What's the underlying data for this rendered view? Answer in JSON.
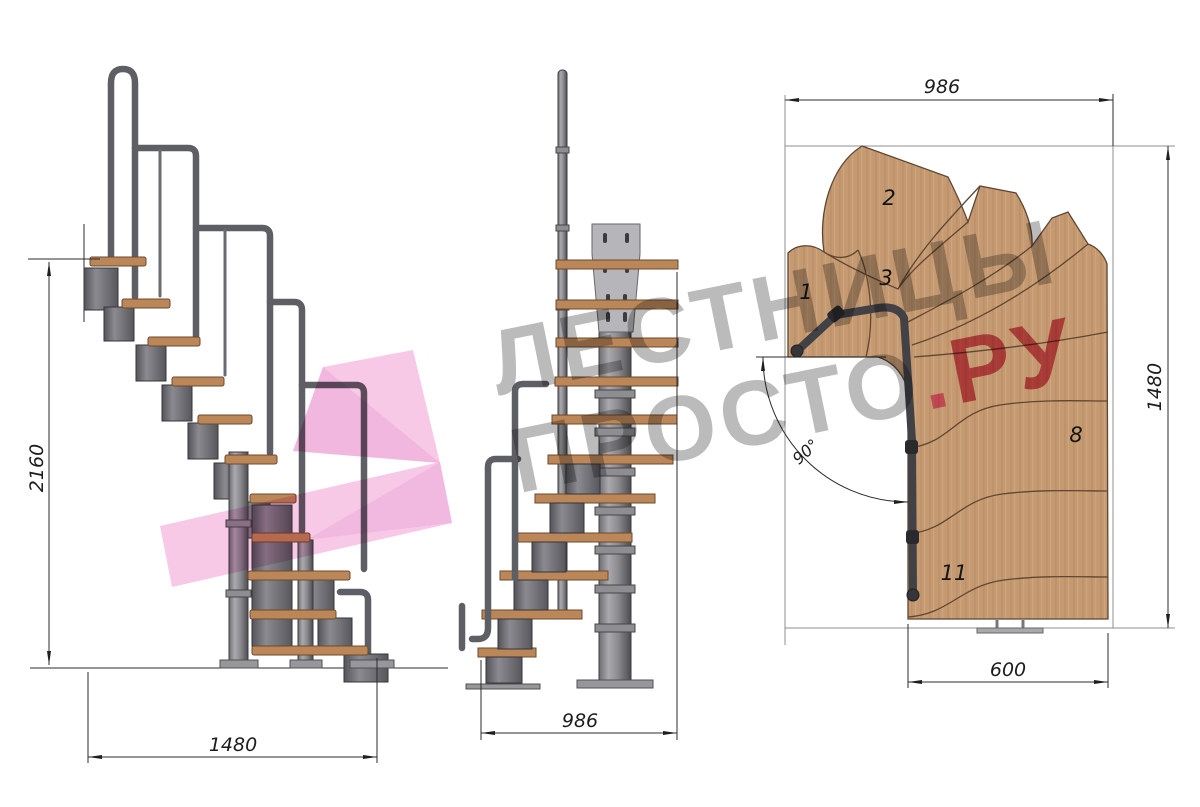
{
  "dimensions": {
    "side_height": "2160",
    "side_length": "1480",
    "front_width": "986",
    "plan_width": "986",
    "plan_depth": "1480",
    "plan_exit_width": "600",
    "plan_angle": "90°"
  },
  "plan_step_labels": {
    "step1": "1",
    "step2": "2",
    "step3": "3",
    "step8": "8",
    "step11": "11"
  },
  "watermark": {
    "line1": "ЛЕСТНИЦЫ",
    "line2_main": "ПРОСТО",
    "line2_dot": ".",
    "line2_suffix": "РУ"
  },
  "palette": {
    "wood": "#c59a71",
    "tread_side": "#bb8758",
    "metal": "#7c7c80",
    "pink_arrow": "#f5bce1",
    "watermark_gray": "#8a8a8a",
    "watermark_red": "#d23a55",
    "watermark_dot_pink": "#f35ca6"
  }
}
